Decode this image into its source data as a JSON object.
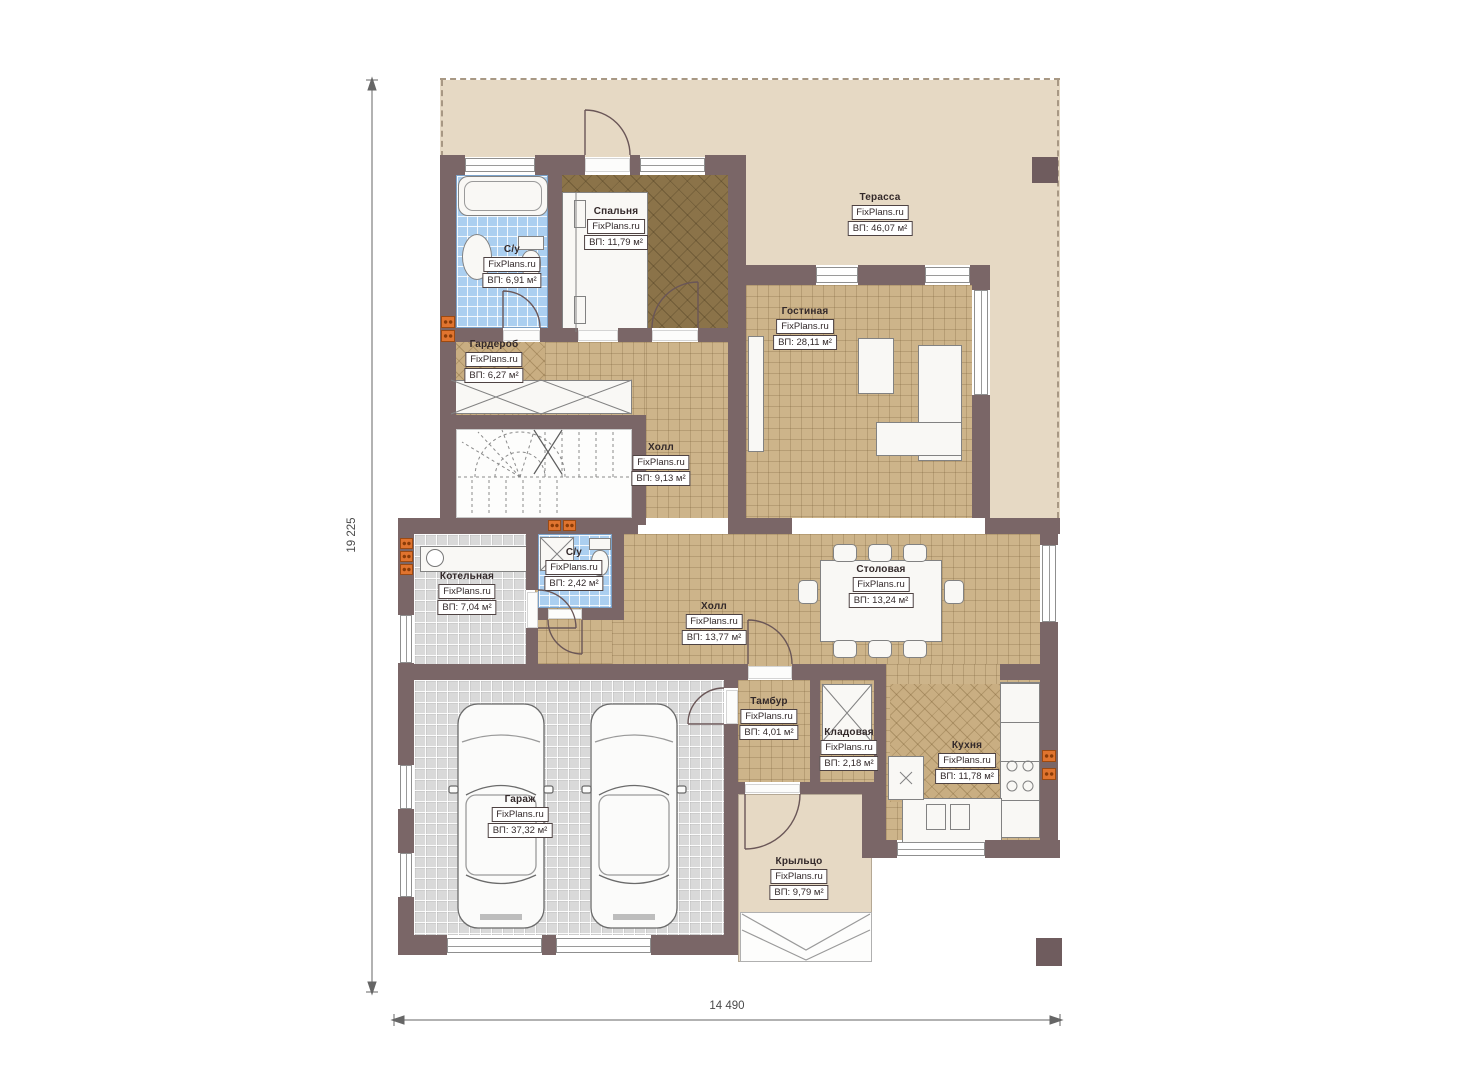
{
  "plan": {
    "brand": "FixPlans.ru",
    "dimensions": {
      "height_label": "19 225",
      "width_label": "14 490"
    },
    "rooms": [
      {
        "name": "Терасса",
        "area": "ВП: 46,07 м²"
      },
      {
        "name": "Спальня",
        "area": "ВП: 11,79 м²"
      },
      {
        "name": "С/у",
        "area": "ВП: 6,91 м²"
      },
      {
        "name": "Гардероб",
        "area": "ВП: 6,27 м²"
      },
      {
        "name": "Гостиная",
        "area": "ВП: 28,11 м²"
      },
      {
        "name": "Холл",
        "area": "ВП: 9,13 м²"
      },
      {
        "name": "Котельная",
        "area": "ВП: 7,04 м²"
      },
      {
        "name": "С/у",
        "area": "ВП: 2,42 м²"
      },
      {
        "name": "Холл",
        "area": "ВП: 13,77 м²"
      },
      {
        "name": "Столовая",
        "area": "ВП: 13,24 м²"
      },
      {
        "name": "Тамбур",
        "area": "ВП: 4,01 м²"
      },
      {
        "name": "Кладовая",
        "area": "ВП: 2,18 м²"
      },
      {
        "name": "Кухня",
        "area": "ВП: 11,78 м²"
      },
      {
        "name": "Гараж",
        "area": "ВП: 37,32 м²"
      },
      {
        "name": "Крыльцо",
        "area": "ВП: 9,79 м²"
      }
    ],
    "colors": {
      "wall": "#7a6667",
      "floor_tile": "#cdb48a",
      "bedroom_floor": "#8b7349",
      "bathroom_floor": "#abcff0",
      "garage_floor": "#d9d9d9",
      "terrace": "#e6d9c4",
      "radiator": "#e0742f"
    }
  }
}
